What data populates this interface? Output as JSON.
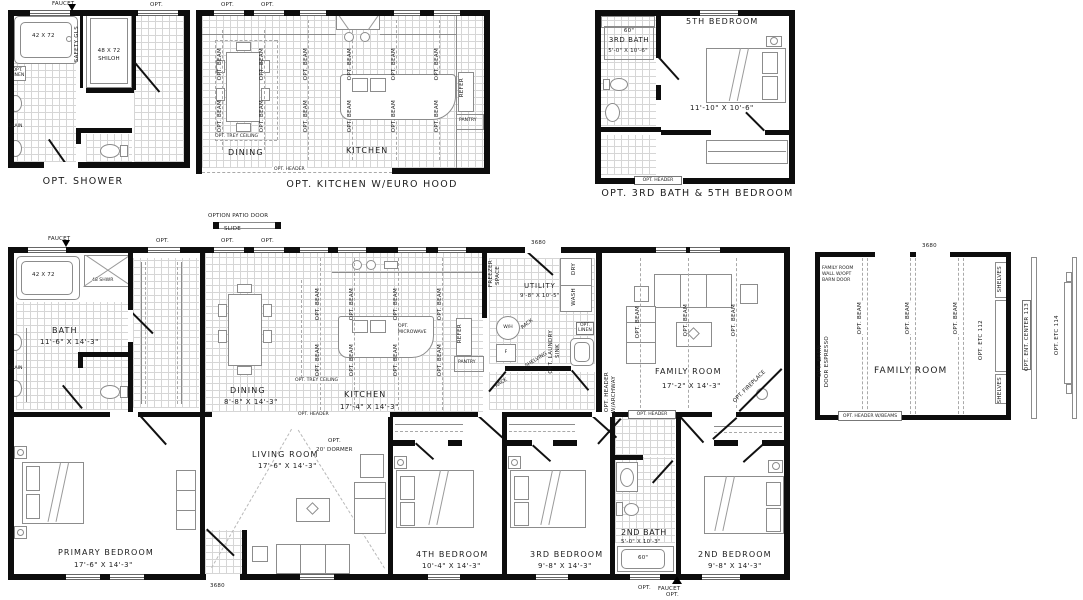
{
  "shared": {
    "opt": "OPT.",
    "faucet": "FAUCET",
    "opt_beam": "OPT. BEAM",
    "opt_header": "OPT. HEADER",
    "d3680": "3680",
    "refer": "REFER",
    "pantry": "PANTRY",
    "drain": "DRAIN",
    "opt_linen": "OPT. LINEN",
    "trey": "OPT. TREY CEILING",
    "wash": "WASH",
    "dry": "DRY",
    "shelves": "SHELVES"
  },
  "opt_shower": {
    "caption": "OPT. SHOWER",
    "tub": "42 X 72",
    "shower_l1": "48 X 72",
    "shower_l2": "SHILOH",
    "safety": "SAFETY GLS"
  },
  "opt_kitchen": {
    "caption": "OPT. KITCHEN W/EURO HOOD",
    "dining": "DINING",
    "kitchen": "KITCHEN"
  },
  "opt_bed5": {
    "caption": "OPT. 3RD BATH & 5TH BEDROOM",
    "bedroom": "5TH BEDROOM",
    "size60": "60\"",
    "bath": "3RD BATH",
    "bath_dim": "5'-0\" X 10'-6\"",
    "bed_dim": "11'-10\" X 10'-6\""
  },
  "main": {
    "patio_l1": "OPTION PATIO DOOR",
    "patio_l2": "SLIDE",
    "bath": "BATH",
    "bath_dim": "11'-6\" X 14'-3\"",
    "tub": "42 X 72",
    "shwr": "48 SHWR",
    "dining": "DINING",
    "dining_dim": "8'-8\" X 14'-3\"",
    "kitchen": "KITCHEN",
    "kitchen_dim": "17'-4\" X 14'-3\"",
    "micro_l1": "OPT.",
    "micro_l2": "MICROWAVE",
    "freezer_l1": "FREEZER",
    "freezer_l2": "SPACE",
    "utility": "UTILITY",
    "utility_dim": "9'-8\" X 10'-5\"",
    "wh": "W/H",
    "f": "F",
    "laundry_l1": "OPT. LAUNDRY",
    "laundry_l2": "SINK",
    "shelving": "SHELVING",
    "rack": "RACK",
    "family": "FAMILY ROOM",
    "family_dim": "17'-2\" X 14'-3\"",
    "fireplace": "OPT. FIREPLACE",
    "archway_l1": "OPT. HEADER",
    "archway_l2": "W/ARCHWAY",
    "primary": "PRIMARY BEDROOM",
    "primary_dim": "17'-6\" X 14'-3\"",
    "living": "LIVING ROOM",
    "living_dim": "17'-6\" X 14'-3\"",
    "dormer_l1": "OPT.",
    "dormer_l2": "20' DORMER",
    "bed4": "4TH BEDROOM",
    "bed4_dim": "10'-4\" X 14'-3\"",
    "bed3": "3RD BEDROOM",
    "bed3_dim": "9'-8\" X 14'-3\"",
    "bath2": "2ND BATH",
    "bath2_dim": "5'-0\" X 10'-3\"",
    "tub60": "60\"",
    "bed2": "2ND BEDROOM",
    "bed2_dim": "9'-8\" X 14'-3\""
  },
  "opt_family": {
    "name": "FAMILY ROOM",
    "corner_l1": "FAMILY ROOM",
    "corner_l2": "WALL W/OPT",
    "corner_l3": "BARN DOOR",
    "barn_l1": "OPT. BARN",
    "barn_l2": "DOOR ESPRESSO",
    "etc": "OPT. ETC 112",
    "header_beams": "OPT. HEADER W/BEAMS",
    "ent_center": "OPT. ENT. CENTER 113",
    "etc2": "OPT. ETC 114"
  }
}
